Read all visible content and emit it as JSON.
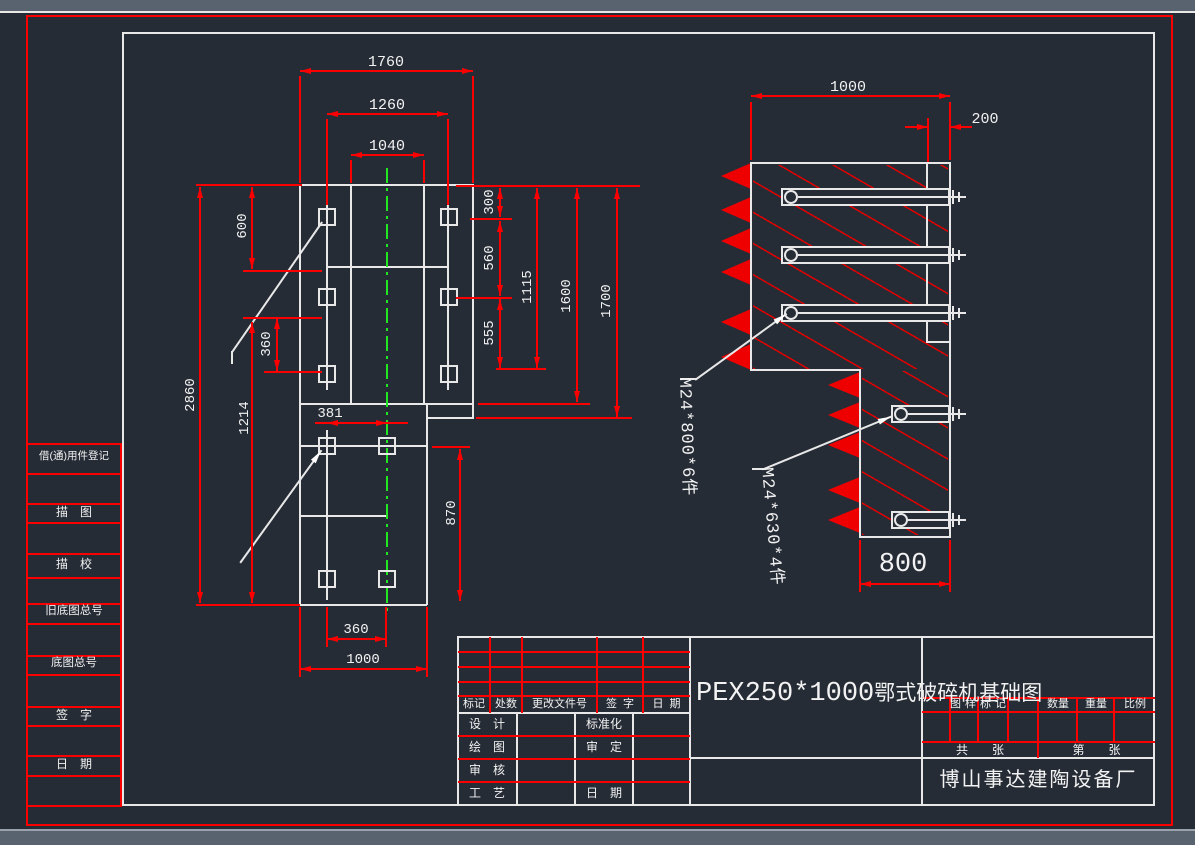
{
  "sidebar": {
    "items": [
      "借(通)用件登记",
      "描　图",
      "描　校",
      "旧底图总号",
      "底图总号",
      "签　字",
      "日　期"
    ]
  },
  "plan": {
    "dim_1760": "1760",
    "dim_1260": "1260",
    "dim_1040": "1040",
    "dim_2860": "2860",
    "dim_600": "600",
    "dim_360_left": "360",
    "dim_1214": "1214",
    "dim_381": "381",
    "dim_300": "300",
    "dim_560": "560",
    "dim_555": "555",
    "dim_1115": "1115",
    "dim_1600": "1600",
    "dim_1700": "1700",
    "dim_870": "870",
    "dim_360_bottom": "360",
    "dim_1000_bottom": "1000"
  },
  "section": {
    "dim_1000": "1000",
    "dim_200": "200",
    "dim_800": "800",
    "label_upper_bolts": "M24*800*6件",
    "label_lower_bolts": "M24*630*4件"
  },
  "titleblock": {
    "rev_headers": [
      "标记",
      "处数",
      "更改文件号",
      "签字",
      "日期"
    ],
    "sig_labels": {
      "design": "设　计",
      "draw": "绘　图",
      "check": "审　核",
      "process": "工　艺",
      "standard": "标准化",
      "approve": "审　定",
      "date": "日　期"
    },
    "title_model": "PEX250*1000",
    "title_name": "鄂式破碎机基础图",
    "right_headers": [
      "图样标记",
      "数量",
      "重量",
      "比例"
    ],
    "sheet_total": "共　　张",
    "sheet_no": "第　　张",
    "company": "博山事达建陶设备厂"
  },
  "colors": {
    "background": "#262c36",
    "geometry": "#e8e8e8",
    "dimension": "#fb0000",
    "centerline": "#22e622",
    "chrome_bar": "#59626f"
  }
}
